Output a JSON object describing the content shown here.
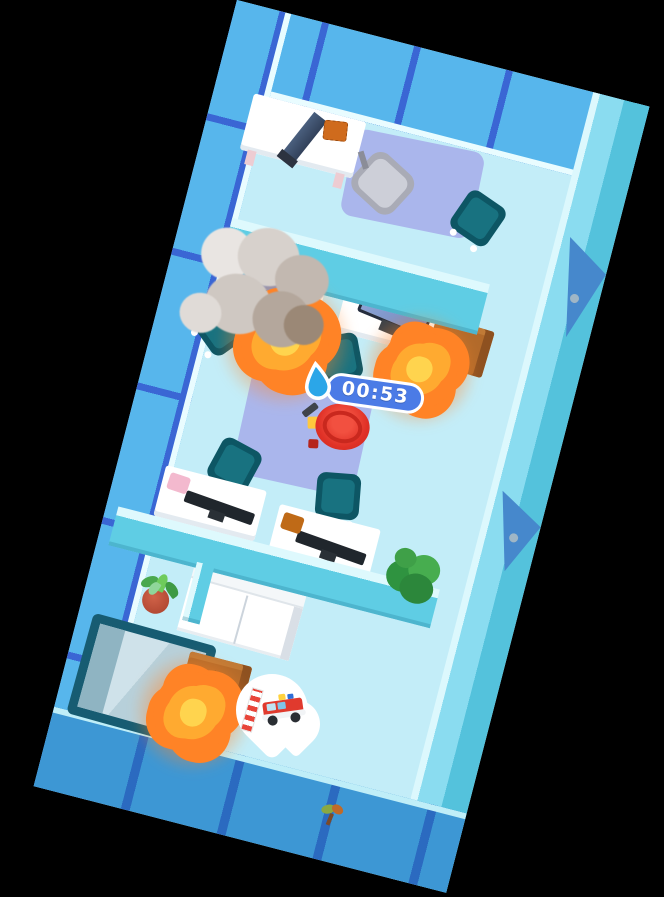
{
  "hud": {
    "timer": {
      "value": "00:53",
      "icon": "water-drop-icon",
      "pill_color": "#4b7be6",
      "text_color": "#ffffff"
    },
    "location_marker": {
      "shape": "map-pin",
      "icon": "fire-truck-icon",
      "secondary_icon": "ladder-icon",
      "color": "#ffffff"
    }
  },
  "scene": {
    "background_color": "#000000",
    "building_rotation_deg": 14.5,
    "rooms": [
      "top-office",
      "main-office",
      "lounge-lobby"
    ],
    "objects": {
      "fires": 3,
      "smoke_plumes": 1,
      "desks": 5,
      "monitors": 5,
      "office_chairs": 5,
      "gray_armchair": 1,
      "rugs": 2,
      "wooden_cabinets": 2,
      "couch": 1,
      "glass_case": 1,
      "potted_plants": 1,
      "bushes": 1,
      "outdoor_saplings": 1,
      "right_wall_doors": 2
    },
    "player": {
      "role": "firefighter",
      "helmet_color": "#e5352a"
    }
  },
  "palette": {
    "window_wall": "#57b6ec",
    "window_mullion": "#3a66d4",
    "interior_wall": "#5fcde4",
    "wall_top": "#def9fd",
    "floor": "#c3edf8",
    "door_blue": "#4688cc",
    "fire_outer": "#ff8326",
    "fire_core": "#ffd44e",
    "chair_teal": "#0d5664",
    "rug_lavender": "#aab6ec",
    "cabinet_brown": "#b26a2a",
    "bottom_wall": "#3d97d4"
  }
}
